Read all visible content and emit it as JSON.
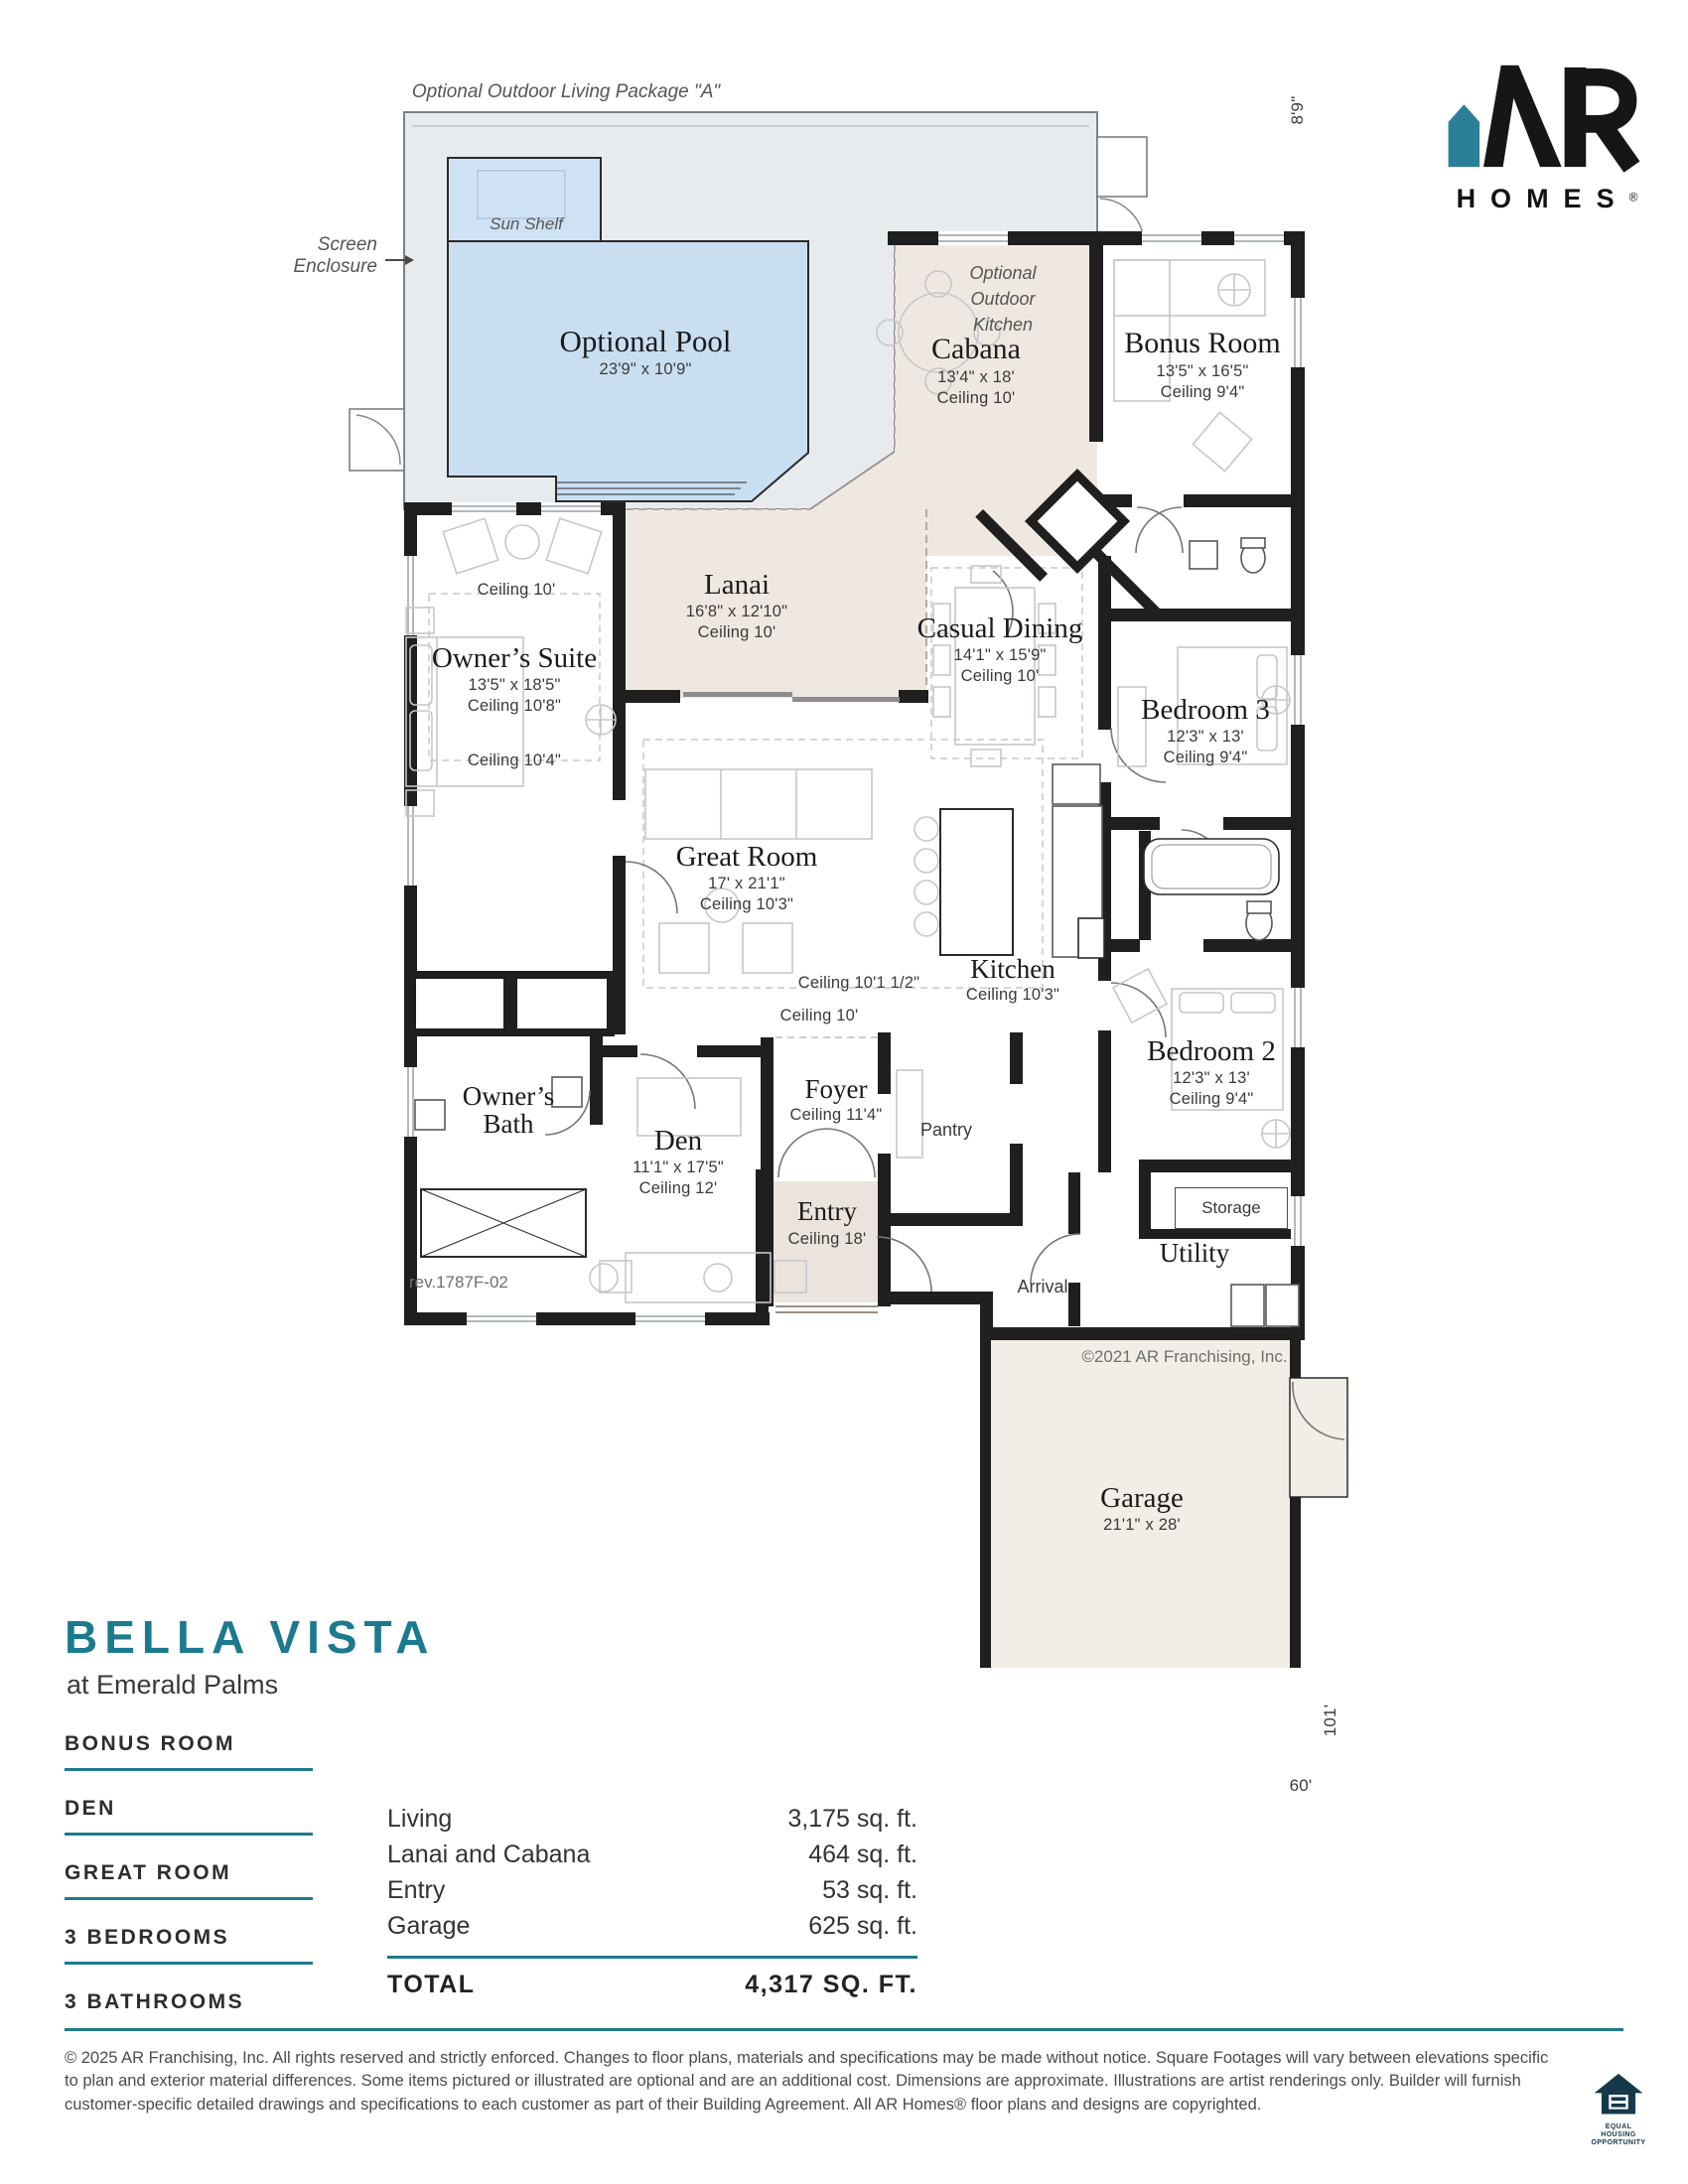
{
  "colors": {
    "accent_teal": "#1c7a8e",
    "logo_teal": "#2b7f96",
    "pool_blue": "#c9def1",
    "deck_grey": "#e8ebed",
    "floor_beige": "#efe8e1",
    "wall_black": "#1f1f1f"
  },
  "logo": {
    "brand": "HOMES",
    "reg": "®"
  },
  "plan": {
    "package_title": "Optional Outdoor Living Package \"A\"",
    "screen_enclosure": {
      "line1": "Screen",
      "line2": "Enclosure"
    },
    "sun_shelf": "Sun Shelf",
    "pool": {
      "name": "Optional Pool",
      "dims": "23'9\" x 10'9\""
    },
    "cabana": {
      "name": "Cabana",
      "dims": "13'4\" x 18'",
      "ceiling": "Ceiling 10'"
    },
    "outdoor_kitchen": {
      "line1": "Optional",
      "line2": "Outdoor",
      "line3": "Kitchen"
    },
    "bonus_room": {
      "name": "Bonus Room",
      "dims": "13'5\" x 16'5\"",
      "ceiling": "Ceiling 9'4\""
    },
    "owners_suite": {
      "name": "Owner’s Suite",
      "dims": "13'5\" x 18'5\"",
      "ceiling": "Ceiling 10'8\"",
      "ceiling_above": "Ceiling 10'",
      "ceiling_below": "Ceiling 10'4\""
    },
    "lanai": {
      "name": "Lanai",
      "dims": "16'8\" x 12'10\"",
      "ceiling": "Ceiling 10'"
    },
    "casual_dining": {
      "name": "Casual Dining",
      "dims": "14'1\" x 15'9\"",
      "ceiling": "Ceiling 10'"
    },
    "bedroom3": {
      "name": "Bedroom 3",
      "dims": "12'3\" x 13'",
      "ceiling": "Ceiling 9'4\""
    },
    "great_room": {
      "name": "Great Room",
      "dims": "17' x 21'1\"",
      "ceiling": "Ceiling 10'3\""
    },
    "kitchen": {
      "name": "Kitchen",
      "ceiling": "Ceiling 10'3\""
    },
    "ceiling_notes": {
      "mid": "Ceiling 10'1 1/2\"",
      "hall": "Ceiling 10'"
    },
    "bedroom2": {
      "name": "Bedroom 2",
      "dims": "12'3\" x 13'",
      "ceiling": "Ceiling 9'4\""
    },
    "owners_bath": {
      "line1": "Owner’s",
      "line2": "Bath"
    },
    "den": {
      "name": "Den",
      "dims": "11'1\" x 17'5\"",
      "ceiling": "Ceiling 12'"
    },
    "foyer": {
      "name": "Foyer",
      "ceiling": "Ceiling 11'4\""
    },
    "pantry": "Pantry",
    "entry": {
      "name": "Entry",
      "ceiling": "Ceiling 18'"
    },
    "storage": "Storage",
    "utility": "Utility",
    "arrival": "Arrival",
    "garage": {
      "name": "Garage",
      "dims": "21'1\" x 28'"
    },
    "rev": "rev.1787F-02",
    "plan_copyright": "©2021 AR Franchising, Inc.",
    "dimensions": {
      "top": "8'9\"",
      "right": "101'",
      "bottom": "60'"
    }
  },
  "info": {
    "title": "BELLA VISTA",
    "subtitle": "at Emerald Palms",
    "features": [
      "BONUS ROOM",
      "DEN",
      "GREAT ROOM",
      "3 BEDROOMS",
      "3 BATHROOMS"
    ],
    "area_table": {
      "rows": [
        {
          "label": "Living",
          "value": "3,175 sq. ft."
        },
        {
          "label": "Lanai and Cabana",
          "value": "464 sq. ft."
        },
        {
          "label": "Entry",
          "value": "53 sq. ft."
        },
        {
          "label": "Garage",
          "value": "625 sq. ft."
        }
      ],
      "total_label": "TOTAL",
      "total_value": "4,317 SQ. FT."
    }
  },
  "footer": {
    "legal": "© 2025 AR Franchising, Inc. All rights reserved and strictly enforced. Changes to floor plans, materials and specifications may be made without notice. Square Footages will vary between elevations specific to plan and exterior material differences. Some items pictured or illustrated are optional and are an additional cost. Dimensions are approximate. Illustrations are artist renderings only. Builder will furnish customer-specific detailed drawings and specifications to each customer as part of their Building Agreement. All AR Homes® floor plans and designs are copyrighted.",
    "equal_housing": {
      "line1": "EQUAL HOUSING",
      "line2": "OPPORTUNITY"
    }
  }
}
